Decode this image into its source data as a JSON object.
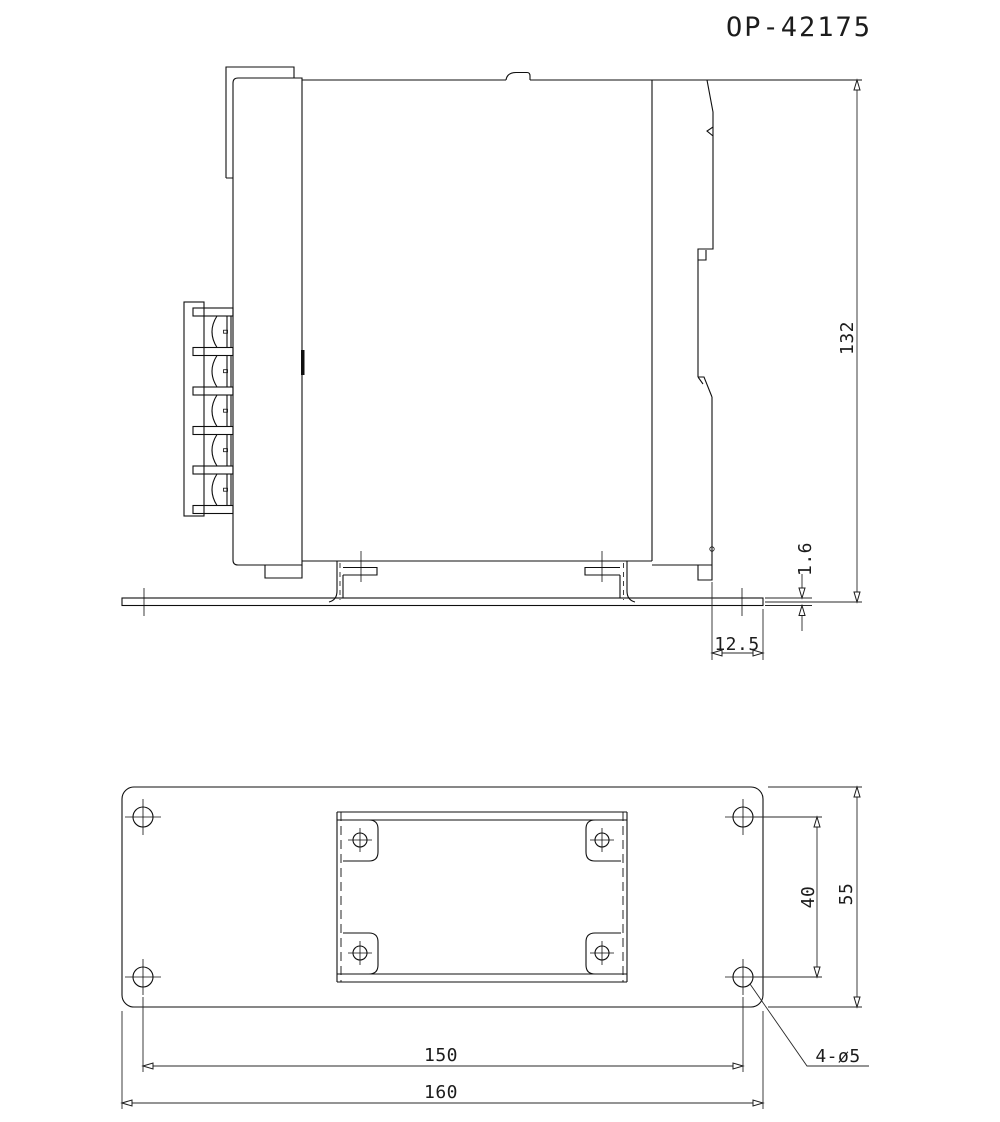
{
  "title": "OP-42175",
  "side_view": {
    "height": "132",
    "plate_thickness": "1.6",
    "rail_offset": "12.5"
  },
  "plan_view": {
    "hole_pitch_x": "150",
    "plate_width": "160",
    "hole_pitch_y": "40",
    "plate_depth": "55",
    "hole_callout": "4-ø5"
  }
}
